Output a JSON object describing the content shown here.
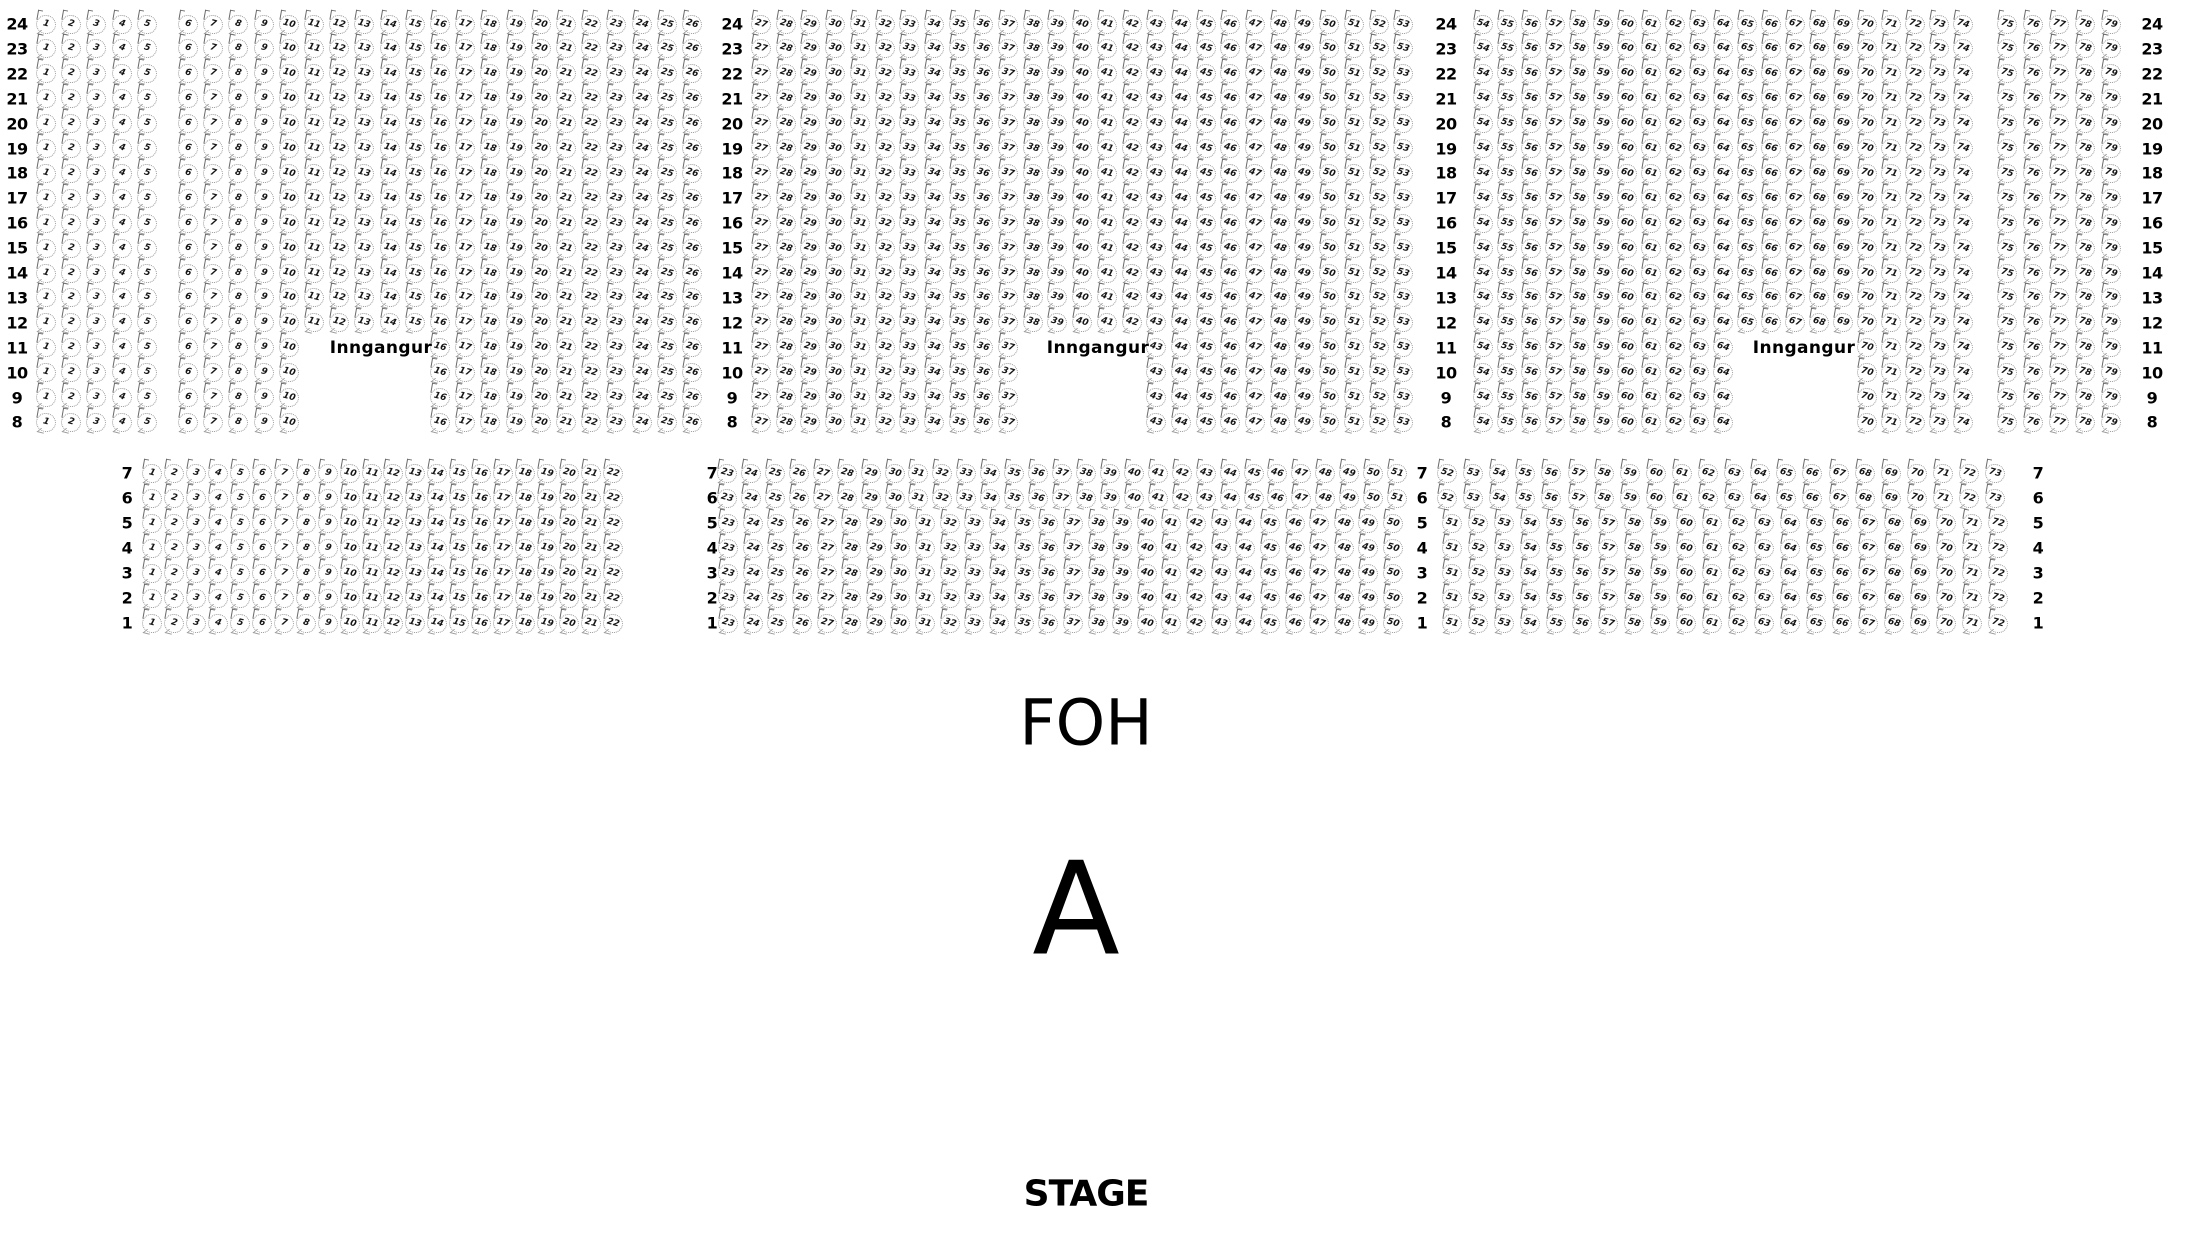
{
  "labels": {
    "foh": "FOH",
    "section": "A",
    "stage": "STAGE",
    "entrance": "Inngangur"
  },
  "seatmap": {
    "top_block": {
      "rows": [
        {
          "row": "24",
          "segments": [
            [
              1,
              5
            ],
            [
              6,
              26
            ],
            [
              27,
              53
            ],
            [
              54,
              74
            ],
            [
              75,
              79
            ]
          ]
        },
        {
          "row": "23",
          "segments": [
            [
              1,
              5
            ],
            [
              6,
              26
            ],
            [
              27,
              53
            ],
            [
              54,
              74
            ],
            [
              75,
              79
            ]
          ]
        },
        {
          "row": "22",
          "segments": [
            [
              1,
              5
            ],
            [
              6,
              26
            ],
            [
              27,
              53
            ],
            [
              54,
              74
            ],
            [
              75,
              79
            ]
          ]
        },
        {
          "row": "21",
          "segments": [
            [
              1,
              5
            ],
            [
              6,
              26
            ],
            [
              27,
              53
            ],
            [
              54,
              74
            ],
            [
              75,
              79
            ]
          ]
        },
        {
          "row": "20",
          "segments": [
            [
              1,
              5
            ],
            [
              6,
              26
            ],
            [
              27,
              53
            ],
            [
              54,
              74
            ],
            [
              75,
              79
            ]
          ]
        },
        {
          "row": "19",
          "segments": [
            [
              1,
              5
            ],
            [
              6,
              26
            ],
            [
              27,
              53
            ],
            [
              54,
              74
            ],
            [
              75,
              79
            ]
          ]
        },
        {
          "row": "18",
          "segments": [
            [
              1,
              5
            ],
            [
              6,
              26
            ],
            [
              27,
              53
            ],
            [
              54,
              74
            ],
            [
              75,
              79
            ]
          ]
        },
        {
          "row": "17",
          "segments": [
            [
              1,
              5
            ],
            [
              6,
              26
            ],
            [
              27,
              53
            ],
            [
              54,
              74
            ],
            [
              75,
              79
            ]
          ]
        },
        {
          "row": "16",
          "segments": [
            [
              1,
              5
            ],
            [
              6,
              26
            ],
            [
              27,
              53
            ],
            [
              54,
              74
            ],
            [
              75,
              79
            ]
          ]
        },
        {
          "row": "15",
          "segments": [
            [
              1,
              5
            ],
            [
              6,
              26
            ],
            [
              27,
              53
            ],
            [
              54,
              74
            ],
            [
              75,
              79
            ]
          ]
        },
        {
          "row": "14",
          "segments": [
            [
              1,
              5
            ],
            [
              6,
              26
            ],
            [
              27,
              53
            ],
            [
              54,
              74
            ],
            [
              75,
              79
            ]
          ]
        },
        {
          "row": "13",
          "segments": [
            [
              1,
              5
            ],
            [
              6,
              26
            ],
            [
              27,
              53
            ],
            [
              54,
              74
            ],
            [
              75,
              79
            ]
          ]
        },
        {
          "row": "12",
          "segments": [
            [
              1,
              5
            ],
            [
              6,
              26
            ],
            [
              27,
              53
            ],
            [
              54,
              74
            ],
            [
              75,
              79
            ]
          ]
        },
        {
          "row": "11",
          "segments": [
            [
              1,
              5
            ],
            [
              6,
              10
            ],
            [
              16,
              26
            ],
            [
              27,
              37
            ],
            [
              43,
              53
            ],
            [
              54,
              64
            ],
            [
              70,
              74
            ],
            [
              75,
              79
            ]
          ],
          "entrances": [
            "Inngangur",
            "Inngangur",
            "Inngangur"
          ]
        },
        {
          "row": "10",
          "segments": [
            [
              1,
              5
            ],
            [
              6,
              10
            ],
            [
              16,
              26
            ],
            [
              27,
              37
            ],
            [
              43,
              53
            ],
            [
              54,
              64
            ],
            [
              70,
              74
            ],
            [
              75,
              79
            ]
          ]
        },
        {
          "row": "9",
          "segments": [
            [
              1,
              5
            ],
            [
              6,
              10
            ],
            [
              16,
              26
            ],
            [
              27,
              37
            ],
            [
              43,
              53
            ],
            [
              54,
              64
            ],
            [
              70,
              74
            ],
            [
              75,
              79
            ]
          ]
        },
        {
          "row": "8",
          "segments": [
            [
              1,
              5
            ],
            [
              6,
              10
            ],
            [
              16,
              26
            ],
            [
              27,
              37
            ],
            [
              43,
              53
            ],
            [
              54,
              64
            ],
            [
              70,
              74
            ],
            [
              75,
              79
            ]
          ]
        }
      ]
    },
    "bottom_block": {
      "rows": [
        {
          "row": "7",
          "segments": [
            [
              1,
              22
            ],
            [
              23,
              51
            ],
            [
              52,
              73
            ]
          ]
        },
        {
          "row": "6",
          "segments": [
            [
              1,
              22
            ],
            [
              23,
              51
            ],
            [
              52,
              73
            ]
          ]
        },
        {
          "row": "5",
          "segments": [
            [
              1,
              22
            ],
            [
              23,
              50
            ],
            [
              51,
              72
            ]
          ]
        },
        {
          "row": "4",
          "segments": [
            [
              1,
              22
            ],
            [
              23,
              50
            ],
            [
              51,
              72
            ]
          ]
        },
        {
          "row": "3",
          "segments": [
            [
              1,
              22
            ],
            [
              23,
              50
            ],
            [
              51,
              72
            ]
          ]
        },
        {
          "row": "2",
          "segments": [
            [
              1,
              22
            ],
            [
              23,
              50
            ],
            [
              51,
              72
            ]
          ]
        },
        {
          "row": "1",
          "segments": [
            [
              1,
              22
            ],
            [
              23,
              50
            ],
            [
              51,
              72
            ]
          ]
        }
      ]
    }
  }
}
